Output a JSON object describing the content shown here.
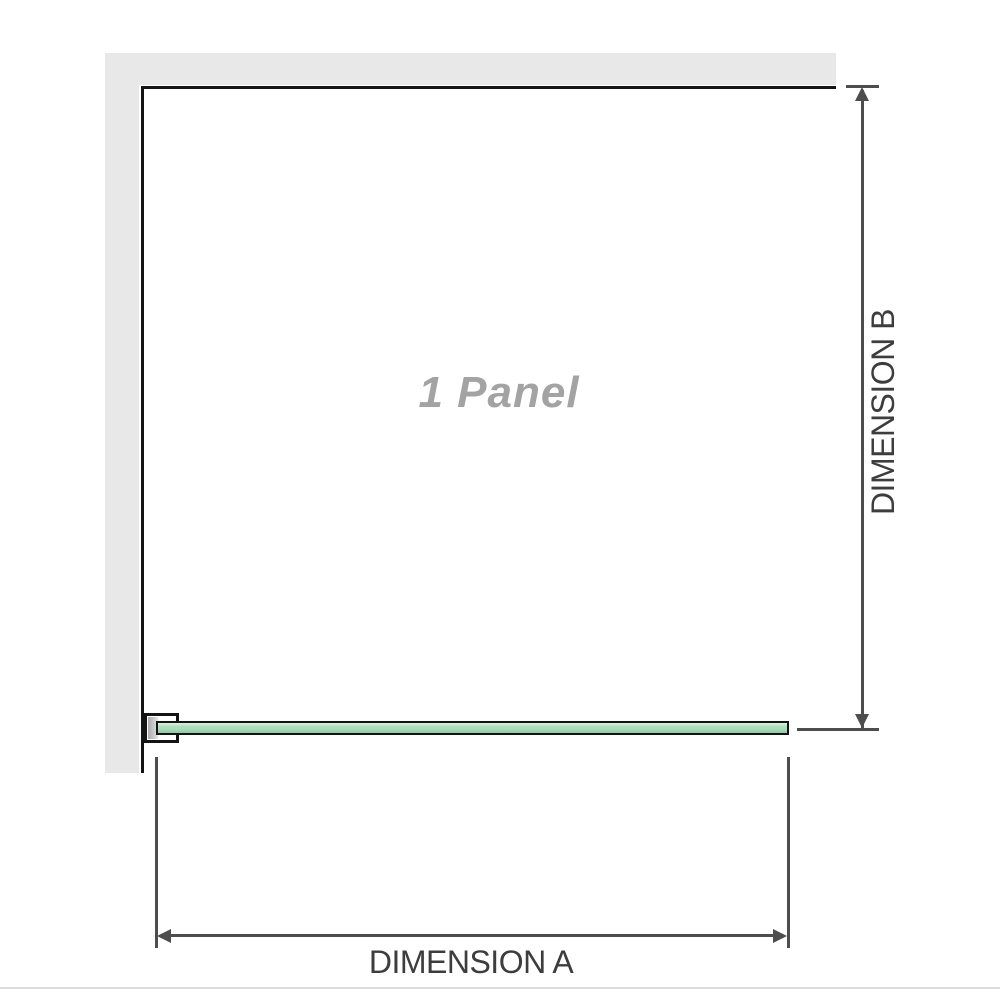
{
  "diagram": {
    "panel_label": "1 Panel",
    "dimension_a_label": "DIMENSION A",
    "dimension_b_label": "DIMENSION B"
  },
  "icons": {
    "arrow_up": "arrow-up-icon",
    "arrow_down": "arrow-down-icon",
    "arrow_left": "arrow-left-icon",
    "arrow_right": "arrow-right-icon"
  },
  "colors": {
    "wall": "#e8e8e8",
    "outline": "#141414",
    "dim": "#4d4d4d",
    "label_text": "#3d3d3d",
    "panel_text": "#a3a3a3",
    "glass_hi": "#ddf0e2",
    "glass_mid": "#aeddbb",
    "glass_lo": "#8bcba0",
    "divider": "#dcdcdc"
  }
}
